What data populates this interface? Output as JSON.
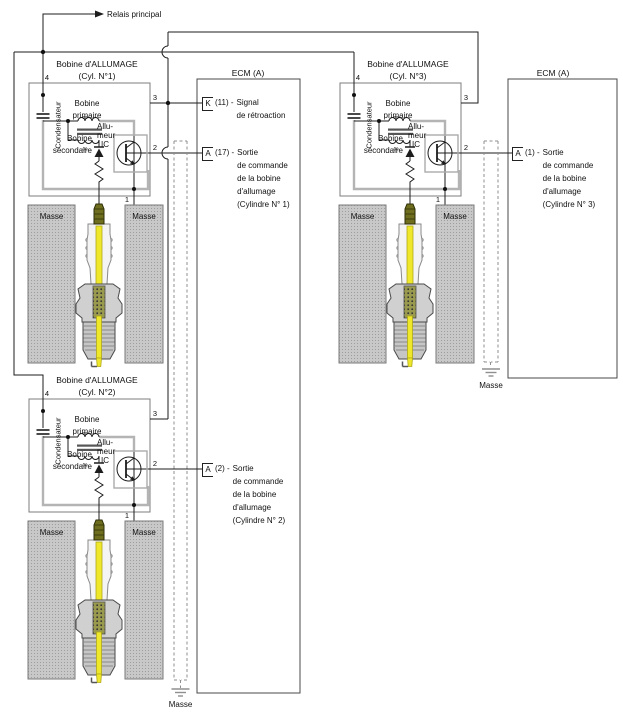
{
  "labels": {
    "relay": "Relais principal",
    "masse": "Masse",
    "winding": "00"
  },
  "ecm_left": {
    "title": "ECM (A)",
    "terminals": [
      {
        "pin_letter": "K",
        "pin_suffix": "(11) - ",
        "lines": [
          "Signal",
          "de rétroaction"
        ]
      },
      {
        "pin_letter": "A",
        "pin_suffix": "(17) - ",
        "lines": [
          "Sortie",
          "de commande",
          "de la bobine",
          "d'allumage",
          "(Cylindre N° 1)"
        ]
      },
      {
        "pin_letter": "A",
        "pin_suffix": "(2) - ",
        "lines": [
          "Sortie",
          "de commande",
          "de la bobine",
          "d'allumage",
          "(Cylindre N° 2)"
        ]
      }
    ]
  },
  "ecm_right": {
    "title": "ECM (A)",
    "terminals": [
      {
        "pin_letter": "A",
        "pin_suffix": "(1) - ",
        "lines": [
          "Sortie",
          "de commande",
          "de la bobine",
          "d'allumage",
          "(Cylindre N° 3)"
        ]
      }
    ]
  },
  "coils": [
    {
      "title1": "Bobine d'ALLUMAGE",
      "title2": "(Cyl. N°1)"
    },
    {
      "title1": "Bobine d'ALLUMAGE",
      "title2": "(Cyl. N°2)"
    },
    {
      "title1": "Bobine d'ALLUMAGE",
      "title2": "(Cyl. N°3)"
    }
  ],
  "coil_labels": {
    "condenser": "Condensateur",
    "primary_line1": "Bobine",
    "primary_line2": "primaire",
    "secondary_line1": "Bobine",
    "secondary_line2": "secondaire",
    "igniter_line1": "Allu-",
    "igniter_line2": "meur",
    "igniter_line3": "IC"
  },
  "pins": {
    "p4": "4",
    "p3": "3",
    "p2": "2",
    "p1": "1"
  },
  "colors": {
    "wire": "#1c1c1c",
    "bus_gray": "#b4b4b4",
    "plug_yellow": "#efe82a",
    "plug_olive": "#6e6e1e",
    "ground_block": "#c8c8c8",
    "dash_gray": "#8f8f8f"
  }
}
